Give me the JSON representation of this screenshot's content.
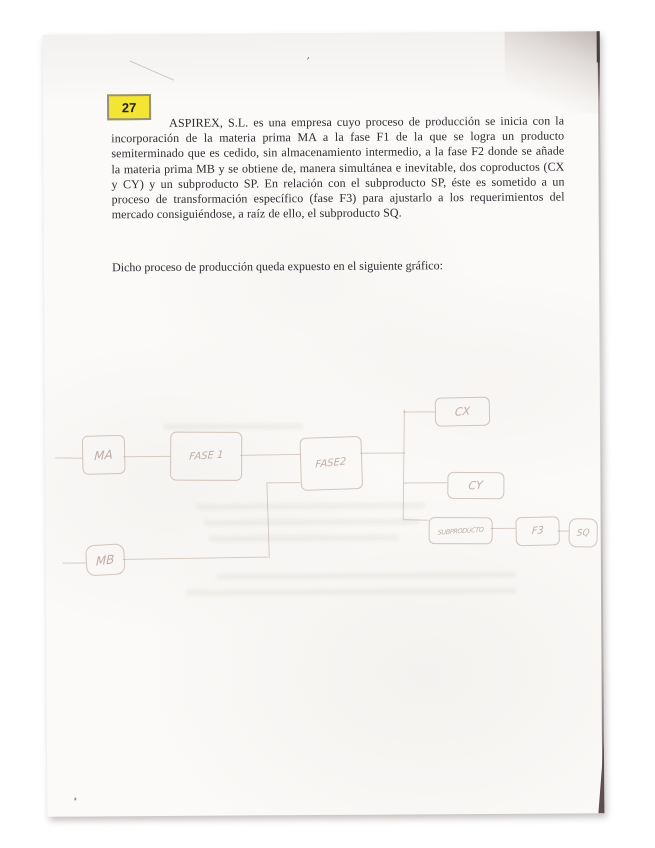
{
  "page": {
    "badge_number": "27",
    "paragraph": "ASPIREX, S.L. es una empresa cuyo proceso de producción se inicia con la incorporación de la materia prima MA a la fase F1 de la que se logra un producto semiterminado que es cedido, sin almacenamiento intermedio, a la fase F2 donde se añade la materia prima MB y se obtiene de, manera simultánea e inevitable, dos coproductos (CX y CY) y un subproducto SP. En relación con el subproducto SP, éste es sometido a un proceso de transformación específico (fase F3) para ajustarlo a los requerimientos del mercado consiguiéndose, a raíz de ello, el subproducto SQ.",
    "caption": "Dicho proceso de producción queda expuesto en el siguiente gráfico:",
    "stray_mark": "’"
  },
  "diagram": {
    "nodes": [
      {
        "id": "ma",
        "label": "MA"
      },
      {
        "id": "fase1",
        "label": "FASE 1"
      },
      {
        "id": "fase2",
        "label": "FASE2"
      },
      {
        "id": "cx",
        "label": "CX"
      },
      {
        "id": "cy",
        "label": "CY"
      },
      {
        "id": "sp",
        "label": "SUBPRODUCTO"
      },
      {
        "id": "f3",
        "label": "F3"
      },
      {
        "id": "sq",
        "label": "SQ"
      },
      {
        "id": "mb",
        "label": "MB"
      }
    ]
  },
  "colors": {
    "highlight_yellow": "#f4e532",
    "paper": "#fbfaf8",
    "ink": "#2b2b31",
    "pencil": "#b09a8f",
    "page_edge_dark": "#5b4f54"
  }
}
